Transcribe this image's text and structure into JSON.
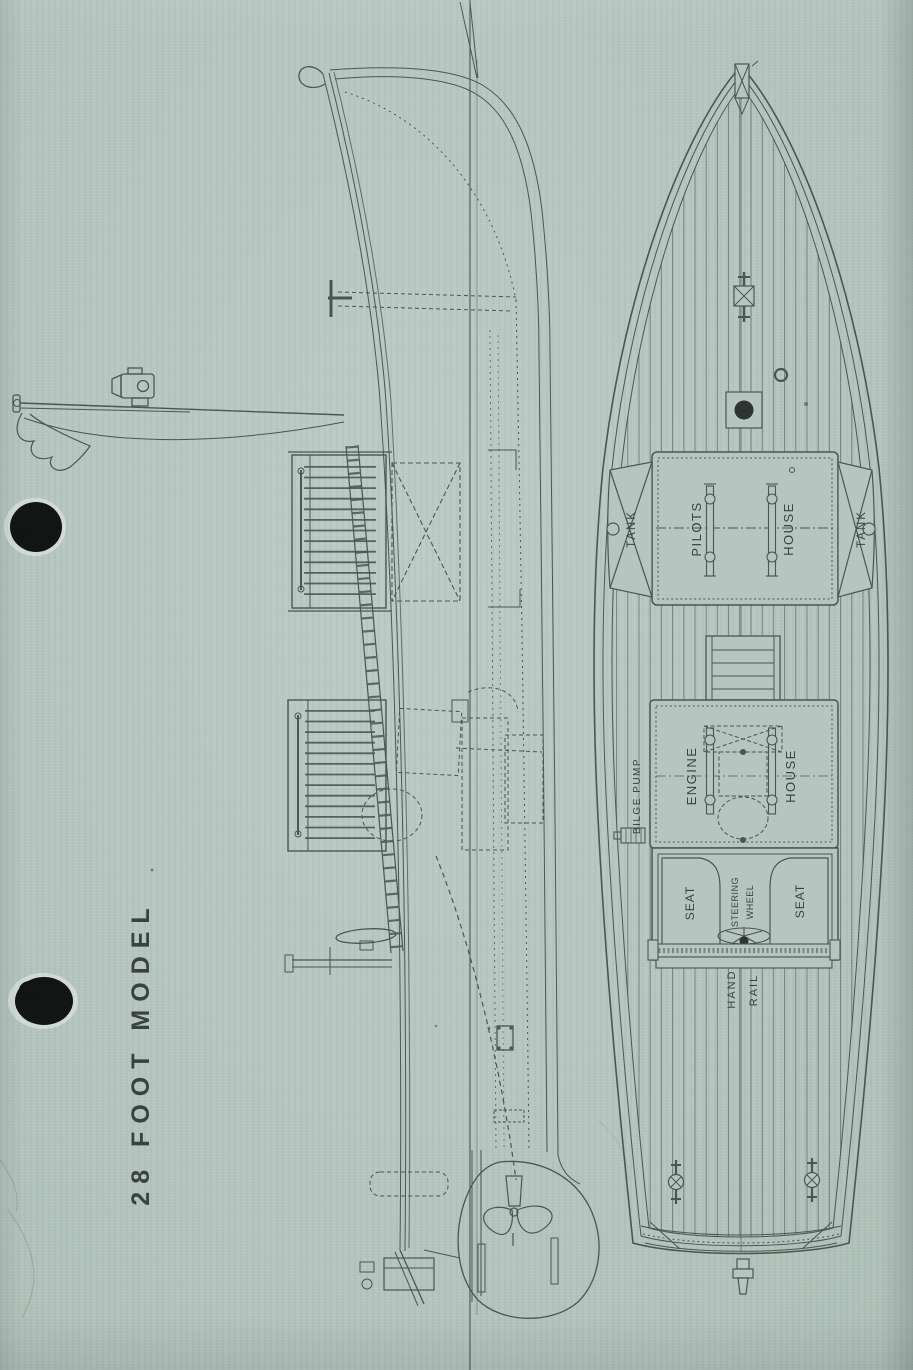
{
  "page": {
    "title": "28 FOOT MODEL",
    "paper_color": "#b6c5bf",
    "ink_color": "#4b5650",
    "label_color": "#3a423e",
    "punch_hole_color": "#111513"
  },
  "plan_view": {
    "labels": {
      "tank_port": "TANK",
      "tank_starboard": "TANK",
      "pilots_line1": "PILOTS",
      "pilots_line2": "HOUSE",
      "bilge_pump": "BILGE PUMP",
      "engine_line1": "ENGINE",
      "engine_line2": "HOUSE",
      "seat_port": "SEAT",
      "seat_starboard": "SEAT",
      "steering_line1": "STEERING",
      "steering_line2": "WHEEL",
      "handrail_line1": "HAND",
      "handrail_line2": "RAIL"
    }
  }
}
